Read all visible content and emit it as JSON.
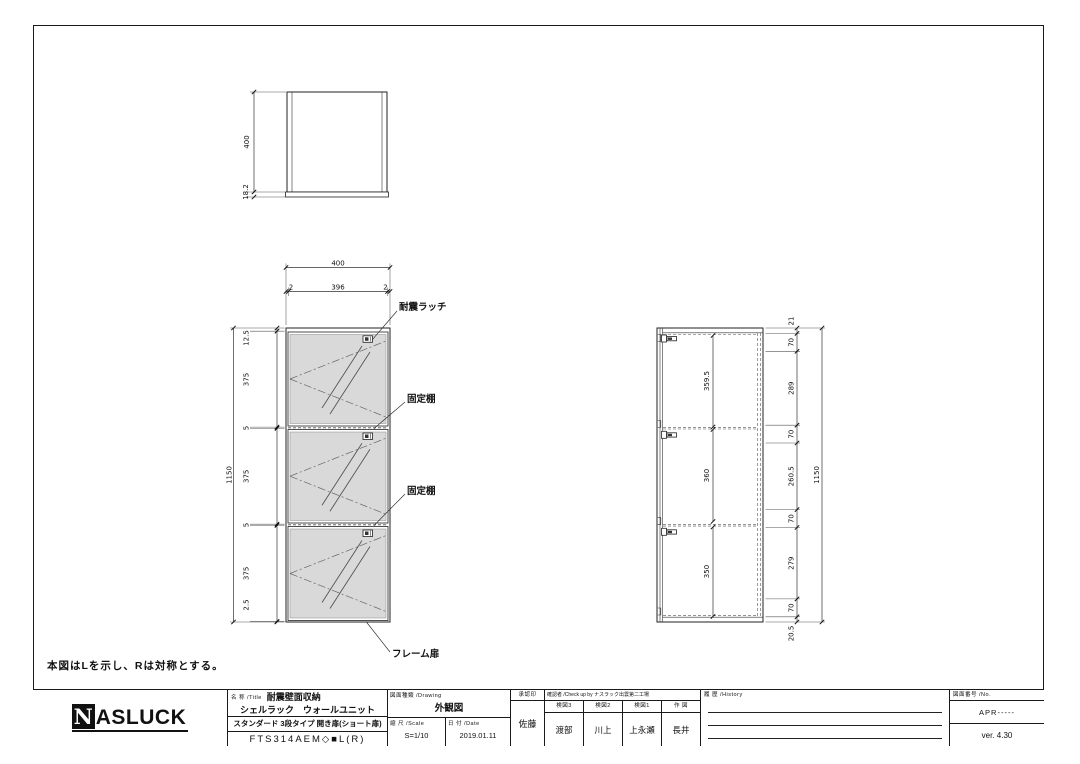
{
  "colors": {
    "line": "#1a1a1a",
    "glass": "#d9d9d9",
    "background": "#ffffff"
  },
  "note": "本図はLを示し、Rは対称とする。",
  "views": {
    "top_view": {
      "dim_height": "400",
      "dim_base": "18.2"
    },
    "front_view": {
      "dim_width": "400",
      "dim_width_parts": [
        "2",
        "396",
        "2"
      ],
      "dim_heights": [
        "12.5",
        "375",
        "5",
        "375",
        "5",
        "375",
        "2.5"
      ],
      "dim_total": "1150",
      "labels": {
        "latch": "耐震ラッチ",
        "shelf": "固定棚",
        "door": "フレーム扉"
      }
    },
    "side_view": {
      "dim_sections": [
        "359.5",
        "360",
        "350"
      ],
      "dim_chain": [
        "21",
        "70",
        "289",
        "70",
        "260.5",
        "70",
        "279",
        "70",
        "20.5"
      ],
      "dim_total": "1150"
    }
  },
  "title_block": {
    "logo": {
      "n": "N",
      "rest": "ASLUCK"
    },
    "title": {
      "header": "名 称 /Title",
      "line1": "耐震壁面収納",
      "line2": "シェルラック　ウォールユニット",
      "line3": "スタンダード 3段タイプ 開き扉(ショート扉)",
      "line4": "FTS314AEM◇■L(R)"
    },
    "drawing": {
      "header": "図面種類 /Drawing",
      "value": "外観図"
    },
    "scale": {
      "header": "縮 尺 /Scale",
      "value": "S=1/10"
    },
    "date": {
      "header": "日 付 /Date",
      "value": "2019.01.11"
    },
    "approval": {
      "header": "承認印",
      "name": "佐藤"
    },
    "check": {
      "header": "確認者 /Check up by ナスラック出雲第二工場",
      "cols": [
        {
          "header": "検図3",
          "name": "渡部"
        },
        {
          "header": "検図2",
          "name": "川上"
        },
        {
          "header": "検図1",
          "name": "上永瀬"
        },
        {
          "header": "作 図",
          "name": "長井"
        }
      ]
    },
    "history": {
      "header": "履 歴 /History"
    },
    "number": {
      "header": "図面番号 /No.",
      "value": "APR-----",
      "version": "ver. 4.30"
    }
  }
}
